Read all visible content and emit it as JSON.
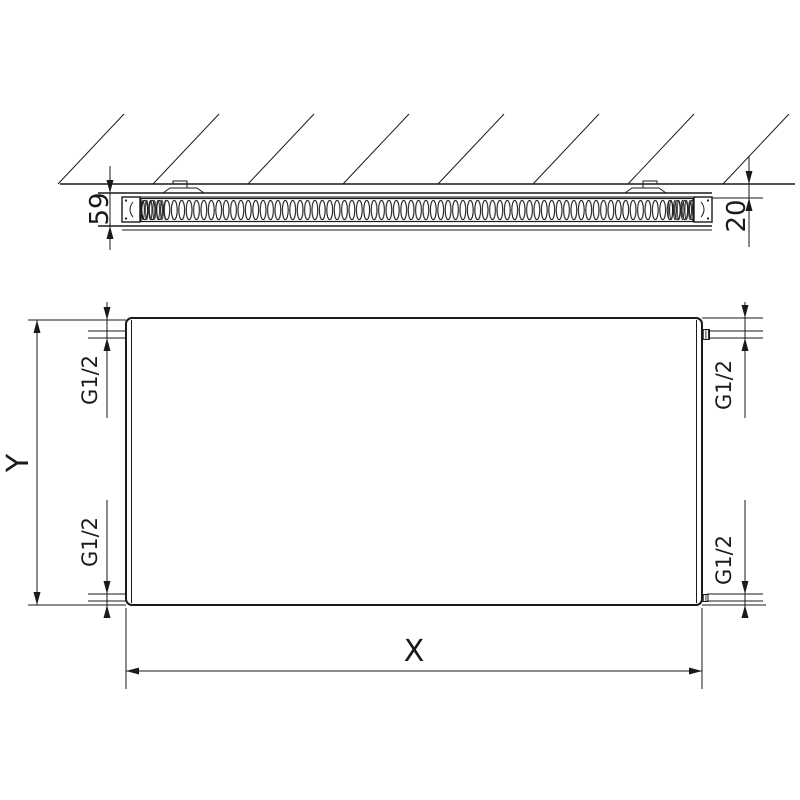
{
  "page": {
    "background": "#ffffff",
    "line_color": "#1a1a1a",
    "description": "Technical dimension drawing of a flat panel radiator: top cross-section mounted to a wall, and front elevation with connection threads"
  },
  "views": {
    "cross_section": {
      "name": "wall-mounted cross-section",
      "dimensions": [
        {
          "id": "depth",
          "label": "59"
        },
        {
          "id": "wall_gap",
          "label": "20"
        }
      ]
    },
    "front": {
      "name": "front elevation",
      "dimensions": [
        {
          "id": "width",
          "label": "X"
        },
        {
          "id": "height",
          "label": "Y"
        },
        {
          "id": "conn_top_left",
          "label": "G1/2"
        },
        {
          "id": "conn_top_right",
          "label": "G1/2"
        },
        {
          "id": "conn_bottom_left",
          "label": "G1/2"
        },
        {
          "id": "conn_bottom_right",
          "label": "G1/2"
        }
      ]
    }
  },
  "labels": {
    "depth": "59",
    "wall_gap": "20",
    "width": "X",
    "height": "Y",
    "conn_tl": "G1/2",
    "conn_tr": "G1/2",
    "conn_bl": "G1/2",
    "conn_br": "G1/2"
  }
}
